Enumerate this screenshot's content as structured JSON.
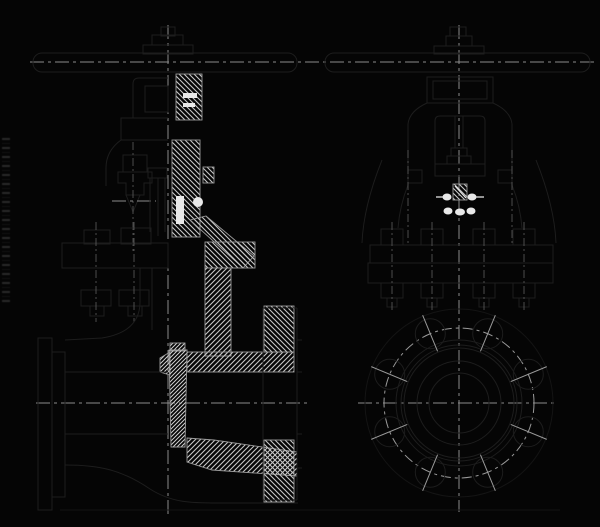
{
  "document": {
    "type": "technical-drawing",
    "title": "Gate valve two-view engineering drawing",
    "views": [
      {
        "id": "side-section",
        "label": "Longitudinal cross-section view"
      },
      {
        "id": "front-elevation",
        "label": "End elevation view"
      }
    ]
  },
  "colors": {
    "background": "#050505",
    "line_dark": "#1d1d1d",
    "line_darker": "#141414",
    "centerline": "#8c8c8c",
    "hatch": "#c6c6c6",
    "hatch_dense": "#cfcfcf",
    "hatch_edge": "#9b9b9b",
    "highlight": "#e9e9e9",
    "bolt_circle": "#9a9a9a"
  },
  "drawing": {
    "left_view_center_x": 168,
    "right_view_center_x": 459,
    "handwheel_axis_y": 62,
    "pipe_axis_y": 403,
    "flange_center": {
      "x": 459,
      "y": 403
    },
    "flange_circles_radii": [
      94,
      63,
      58,
      55,
      42,
      30
    ],
    "bolt_circle_radius": 75,
    "bolt_hole_count": 8,
    "bolt_hole_radius": 15,
    "bolt_hole_start_angle_deg": 22.5,
    "bolt_tick_inner_radius": 56,
    "bolt_tick_outer_radius": 95
  }
}
